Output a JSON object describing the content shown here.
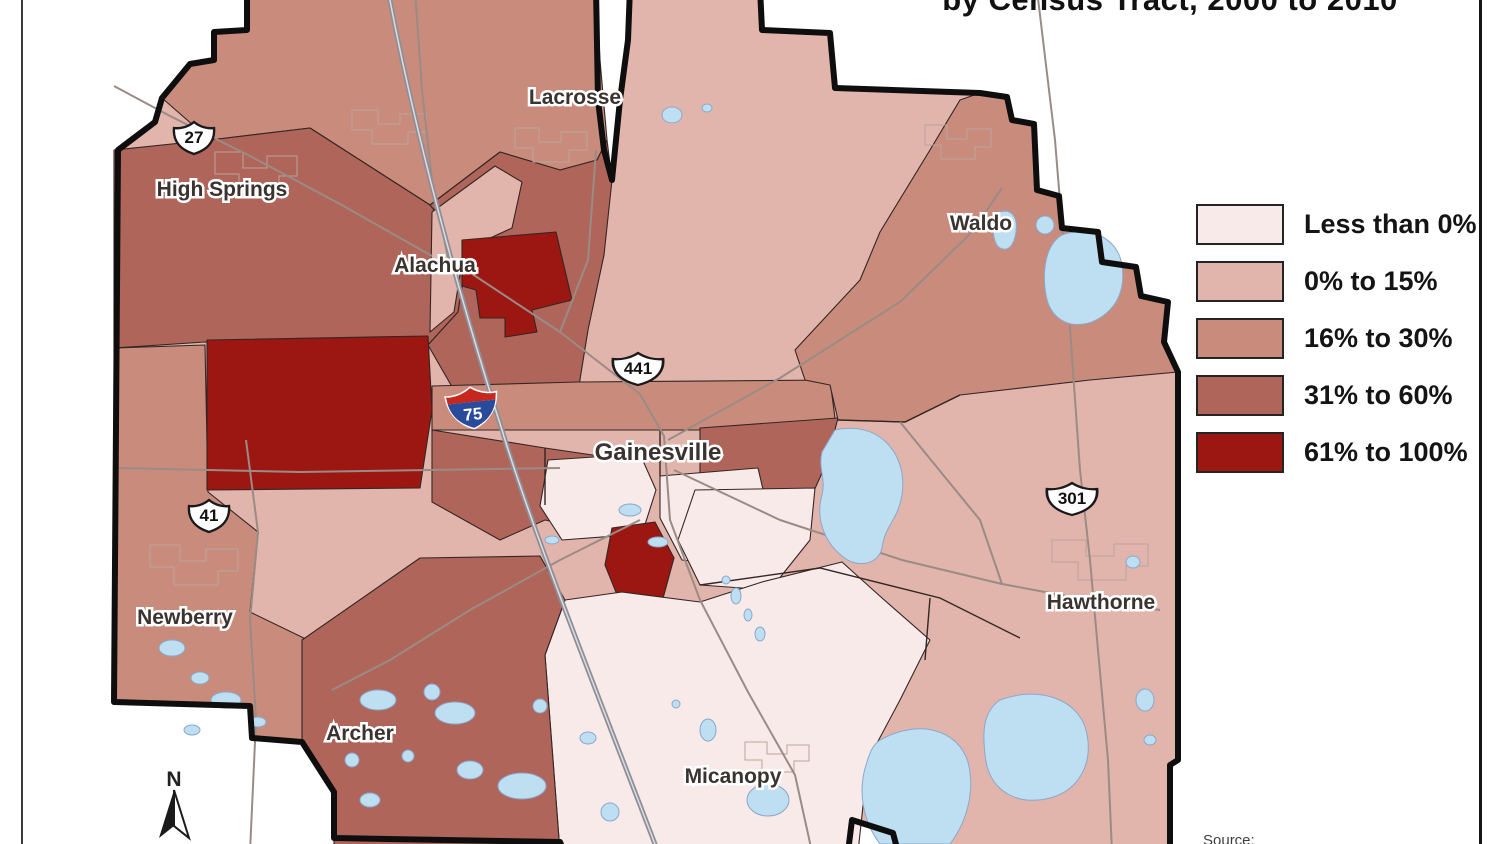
{
  "title": "by Census Tract, 2000 to 2010",
  "source_label": "Source:",
  "north": {
    "label": "N"
  },
  "legend": {
    "items": [
      {
        "label": "Less than 0%",
        "color": "#f7eae8"
      },
      {
        "label": "0% to 15%",
        "color": "#e1b5ac"
      },
      {
        "label": "16% to 30%",
        "color": "#c98c7c"
      },
      {
        "label": "31% to 60%",
        "color": "#b0655a"
      },
      {
        "label": "61% to 100%",
        "color": "#9c1711"
      }
    ]
  },
  "map": {
    "cities": [
      {
        "label": "Lacrosse"
      },
      {
        "label": "High Springs"
      },
      {
        "label": "Alachua"
      },
      {
        "label": "Waldo"
      },
      {
        "label": "Gainesville"
      },
      {
        "label": "Newberry"
      },
      {
        "label": "Archer"
      },
      {
        "label": "Micanopy"
      },
      {
        "label": "Hawthorne"
      }
    ],
    "highways": [
      {
        "type": "us-route",
        "number": "27"
      },
      {
        "type": "us-route",
        "number": "441"
      },
      {
        "type": "interstate",
        "number": "75"
      },
      {
        "type": "us-route",
        "number": "41"
      },
      {
        "type": "us-route",
        "number": "301"
      }
    ],
    "colors": {
      "lake": "#bedef2",
      "county_border": "#0e0e0e",
      "road": "#9b8b85"
    }
  }
}
